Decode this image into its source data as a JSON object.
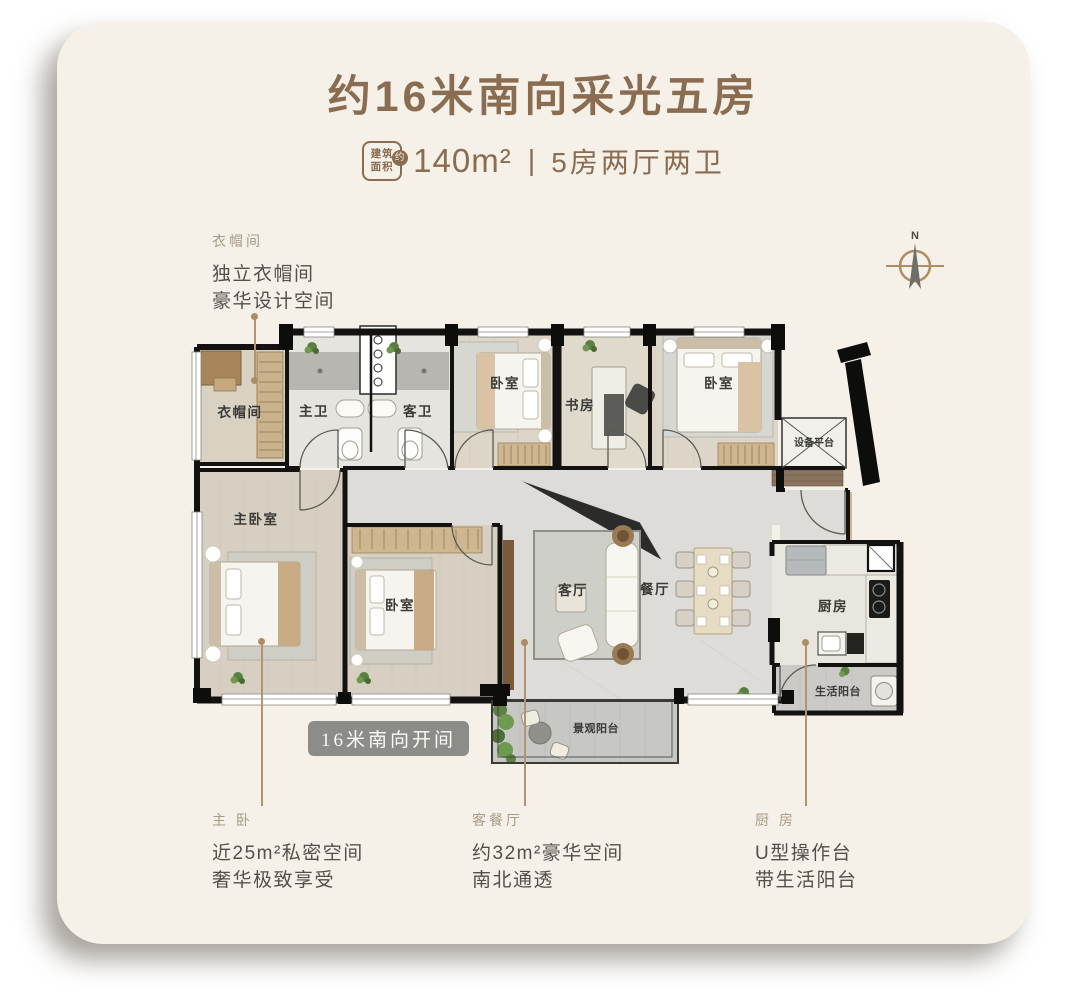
{
  "header": {
    "title": "约16米南向采光五房",
    "area_label_line1": "建筑",
    "area_label_line2": "面积",
    "area_label_circle": "约",
    "area_value": "140m²",
    "divider": "|",
    "spec": "5房两厅两卫"
  },
  "compass": {
    "north": "N"
  },
  "callouts": {
    "cloakroom": {
      "heading": "衣帽间",
      "line1": "独立衣帽间",
      "line2": "豪华设计空间"
    },
    "master": {
      "heading": "主 卧",
      "line1": "近25m²私密空间",
      "line2": "奢华极致享受"
    },
    "living": {
      "heading": "客餐厅",
      "line1": "约32m²豪华空间",
      "line2": "南北通透"
    },
    "kitchen": {
      "heading": "厨 房",
      "line1": "U型操作台",
      "line2": "带生活阳台"
    }
  },
  "floorplan": {
    "orientation_badge": "16米南向开间",
    "rooms": {
      "cloakroom": "衣帽间",
      "master_bath": "主卫",
      "guest_bath": "客卫",
      "bedroom_top_left": "卧室",
      "study": "书房",
      "bedroom_top_right": "卧室",
      "equipment_platform": "设备平台",
      "master_bedroom": "主卧室",
      "bedroom_south": "卧室",
      "living_room": "客厅",
      "dining_room": "餐厅",
      "kitchen": "厨房",
      "service_balcony": "生活阳台",
      "view_balcony": "景观阳台"
    }
  },
  "colors": {
    "card_bg": "#f6f1e8",
    "accent_brown": "#8a6c50",
    "leader_tan": "#b2946f",
    "orientation_badge_bg": "#8c8c88",
    "callout_heading": "#a89b89",
    "callout_body": "#53504a"
  }
}
